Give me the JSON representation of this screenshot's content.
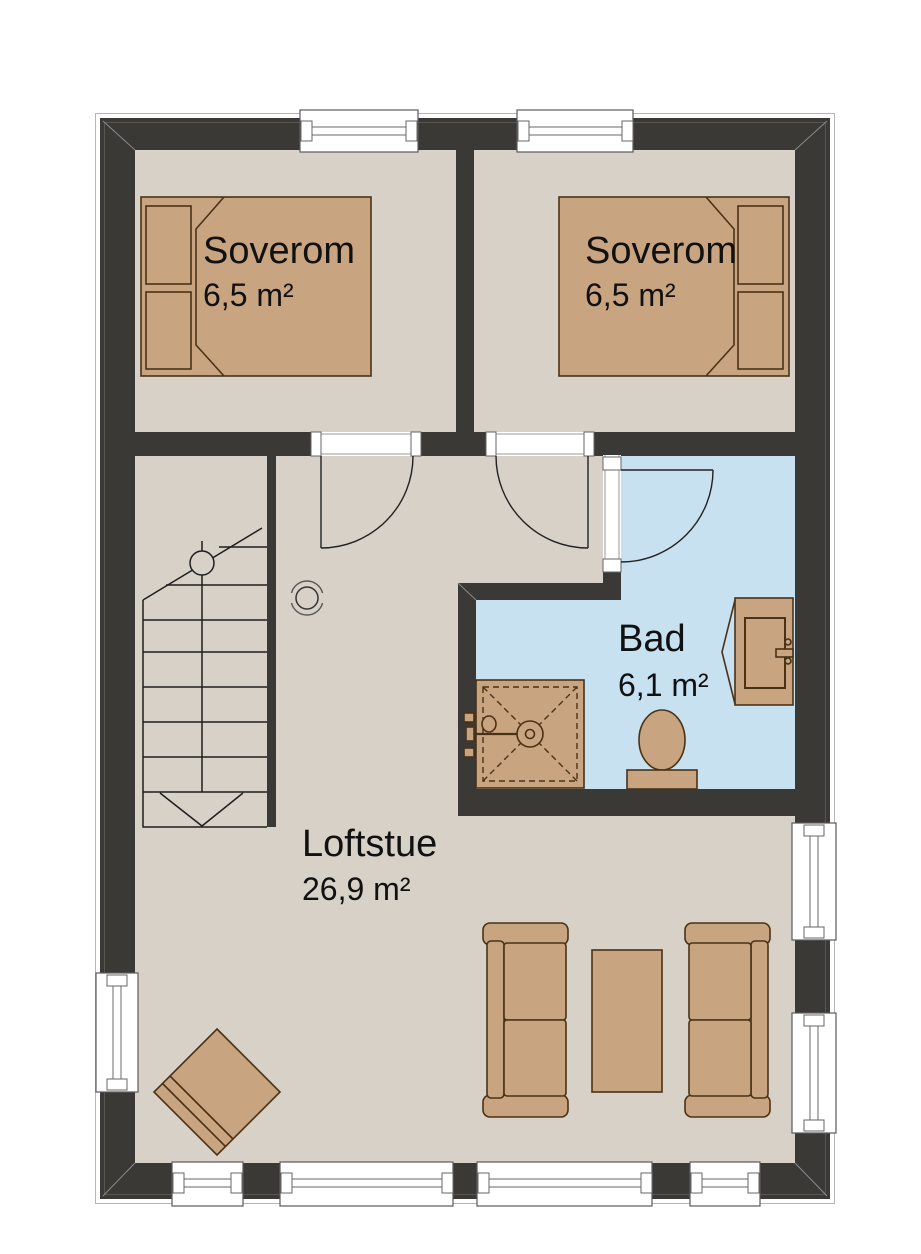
{
  "plan": {
    "type": "floor-plan",
    "floor": "loft",
    "rooms": [
      {
        "id": "soverom-1",
        "name": "Soverom",
        "area": "6,5 m²"
      },
      {
        "id": "soverom-2",
        "name": "Soverom",
        "area": "6,5 m²"
      },
      {
        "id": "bad",
        "name": "Bad",
        "area": "6,1 m²"
      },
      {
        "id": "loftstue",
        "name": "Loftstue",
        "area": "26,9 m²"
      }
    ],
    "fixtures": [
      "double-bed",
      "double-bed",
      "staircase",
      "chimney-symbol",
      "shower",
      "toilet",
      "sink-vanity",
      "sofa",
      "sofa",
      "coffee-table",
      "corner-armchair"
    ]
  },
  "colors": {
    "wall": "#3b3936",
    "floor": "#d7d1c7",
    "bathroom_floor": "#c8e1f1",
    "furniture": "#c9a481",
    "furniture_outline": "#4a3216",
    "window": "#ffffff",
    "background": "#ffffff"
  }
}
